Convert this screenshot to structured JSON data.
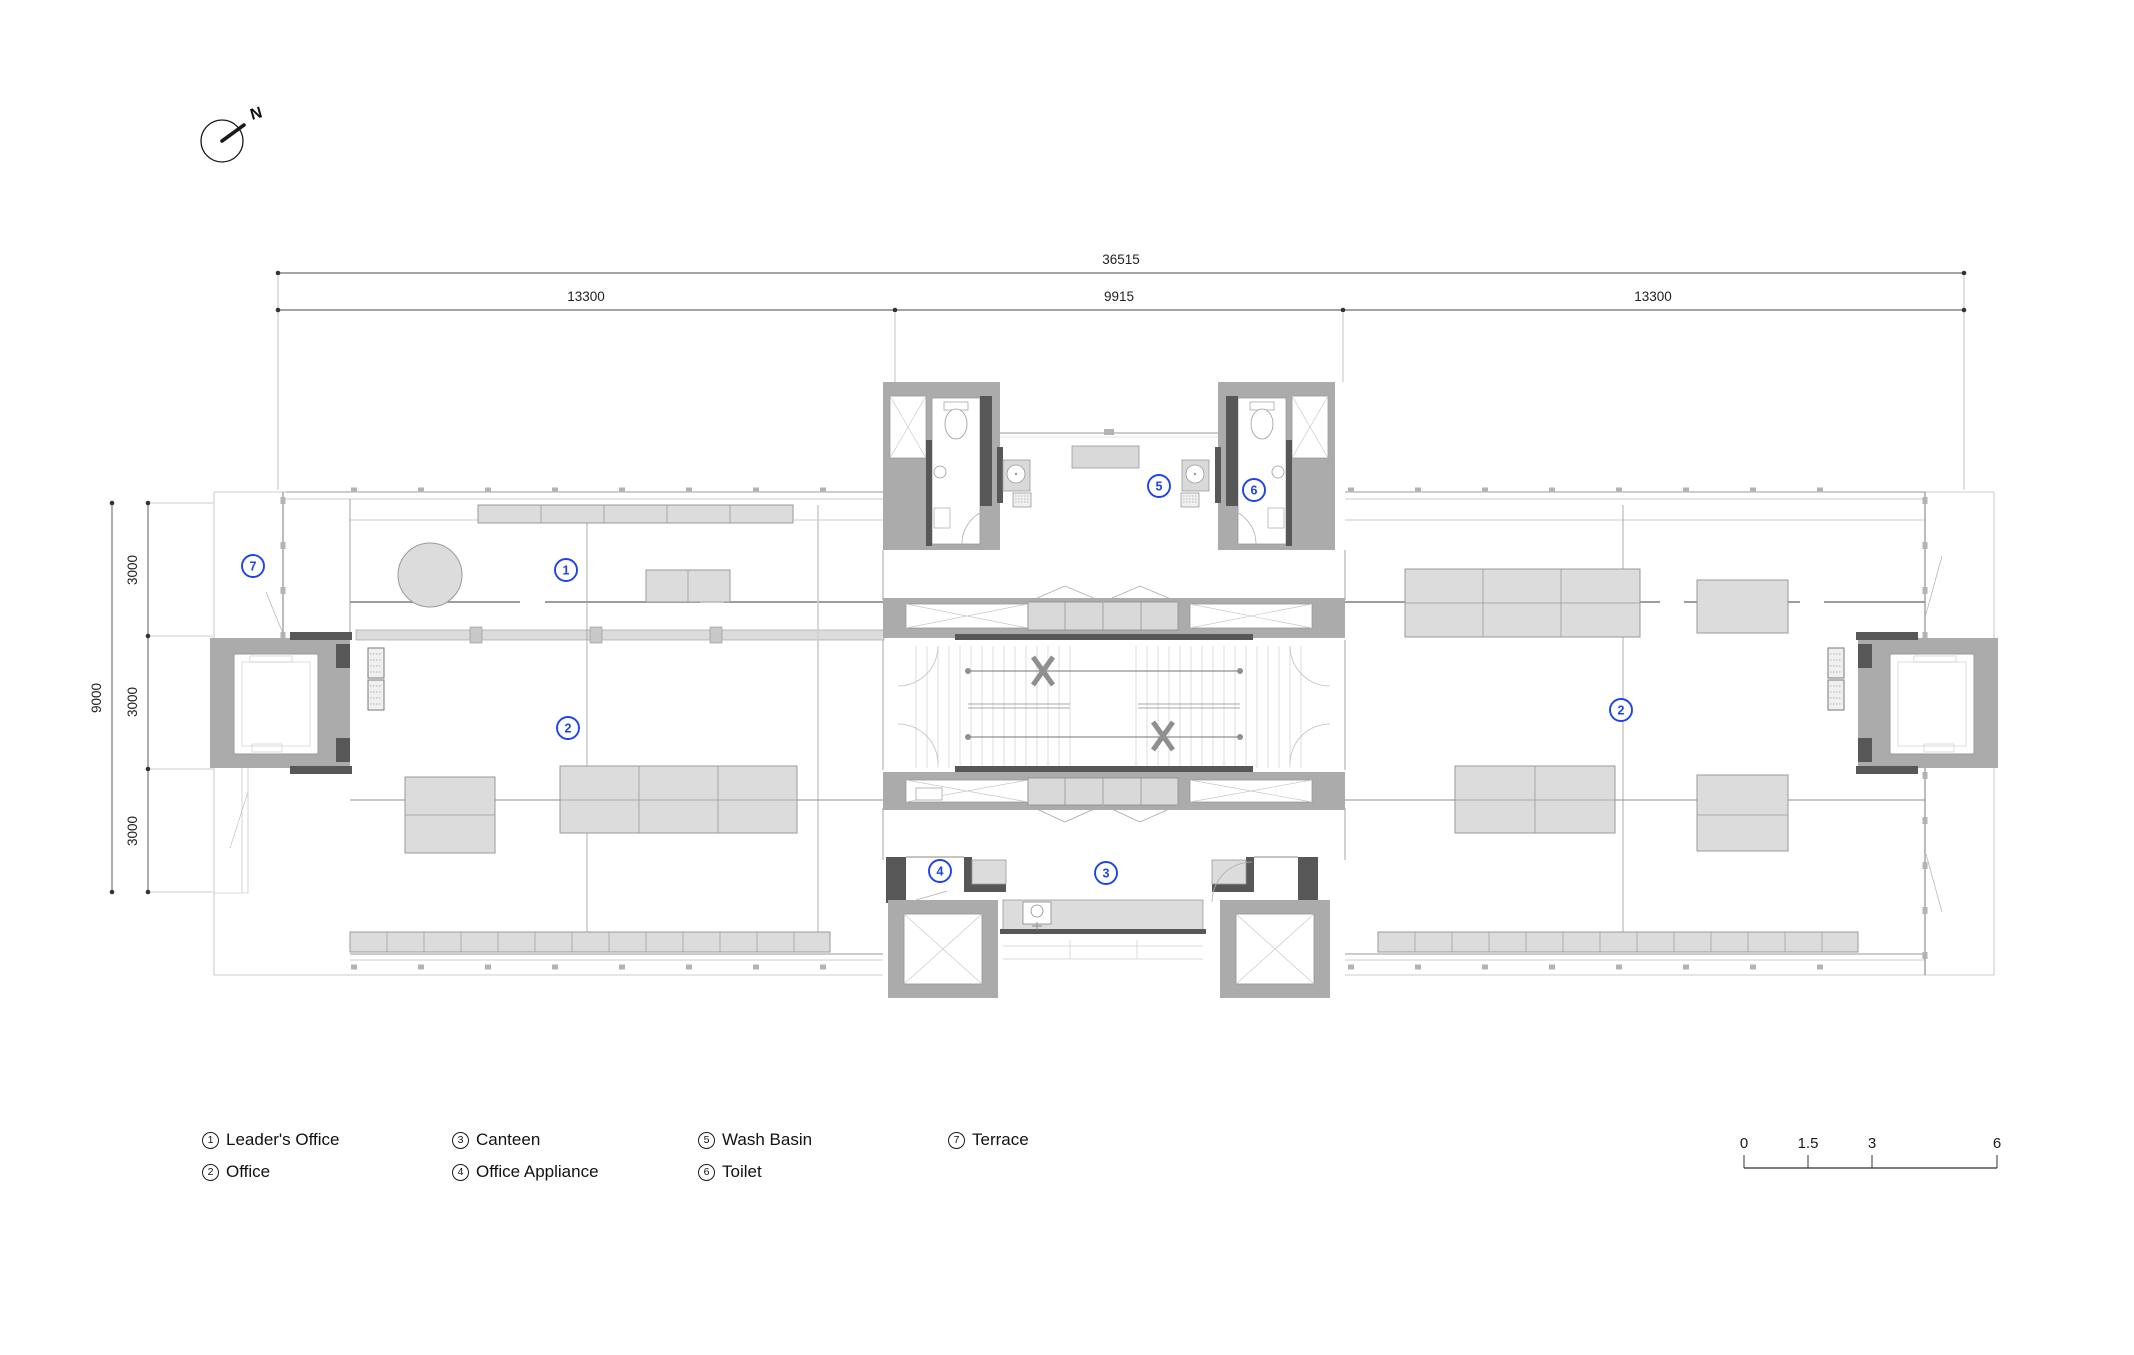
{
  "north_arrow": {
    "label": "N"
  },
  "dimensions": {
    "top": {
      "total": "36515",
      "segments": [
        "13300",
        "9915",
        "13300"
      ]
    },
    "left": {
      "total": "9000",
      "segments": [
        "3000",
        "3000",
        "3000"
      ]
    }
  },
  "plan": {
    "room_labels": [
      "7",
      "1",
      "2",
      "5",
      "6",
      "4",
      "3",
      "2"
    ]
  },
  "legend": {
    "items": [
      {
        "number": "1",
        "label": "Leader's Office"
      },
      {
        "number": "2",
        "label": "Office"
      },
      {
        "number": "3",
        "label": "Canteen"
      },
      {
        "number": "4",
        "label": "Office Appliance"
      },
      {
        "number": "5",
        "label": "Wash Basin"
      },
      {
        "number": "6",
        "label": "Toilet"
      },
      {
        "number": "7",
        "label": "Terrace"
      }
    ]
  },
  "scale_bar": {
    "ticks": [
      "0",
      "1.5",
      "3",
      "6"
    ]
  },
  "colors": {
    "label_blue": "#1d43ea",
    "wall_gray": "#ababab",
    "wall_dark": "#575757",
    "furniture_fill": "#dcdcdc",
    "line_gray": "#8f8f8f",
    "text_black": "#1a1a1a"
  }
}
